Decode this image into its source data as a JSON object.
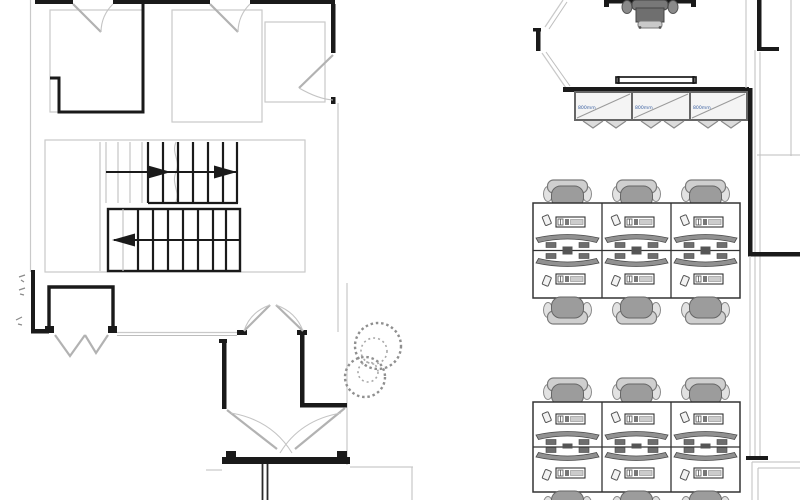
{
  "drawing": {
    "kind": "architectural floor plan",
    "left_area": "stair lobby with rooms and entrance",
    "right_area": "open office with workstations"
  },
  "cabinets": [
    {
      "label": "800mm"
    },
    {
      "label": "800mm"
    },
    {
      "label": "800mm"
    }
  ],
  "colors": {
    "wall": "#1a1a1a",
    "secondary_line": "#c9c9c9",
    "furniture_gray": "#9c9c9c",
    "cabinet_fill": "#f4f4f4",
    "cabinet_label_text": "#3a5fa0"
  }
}
